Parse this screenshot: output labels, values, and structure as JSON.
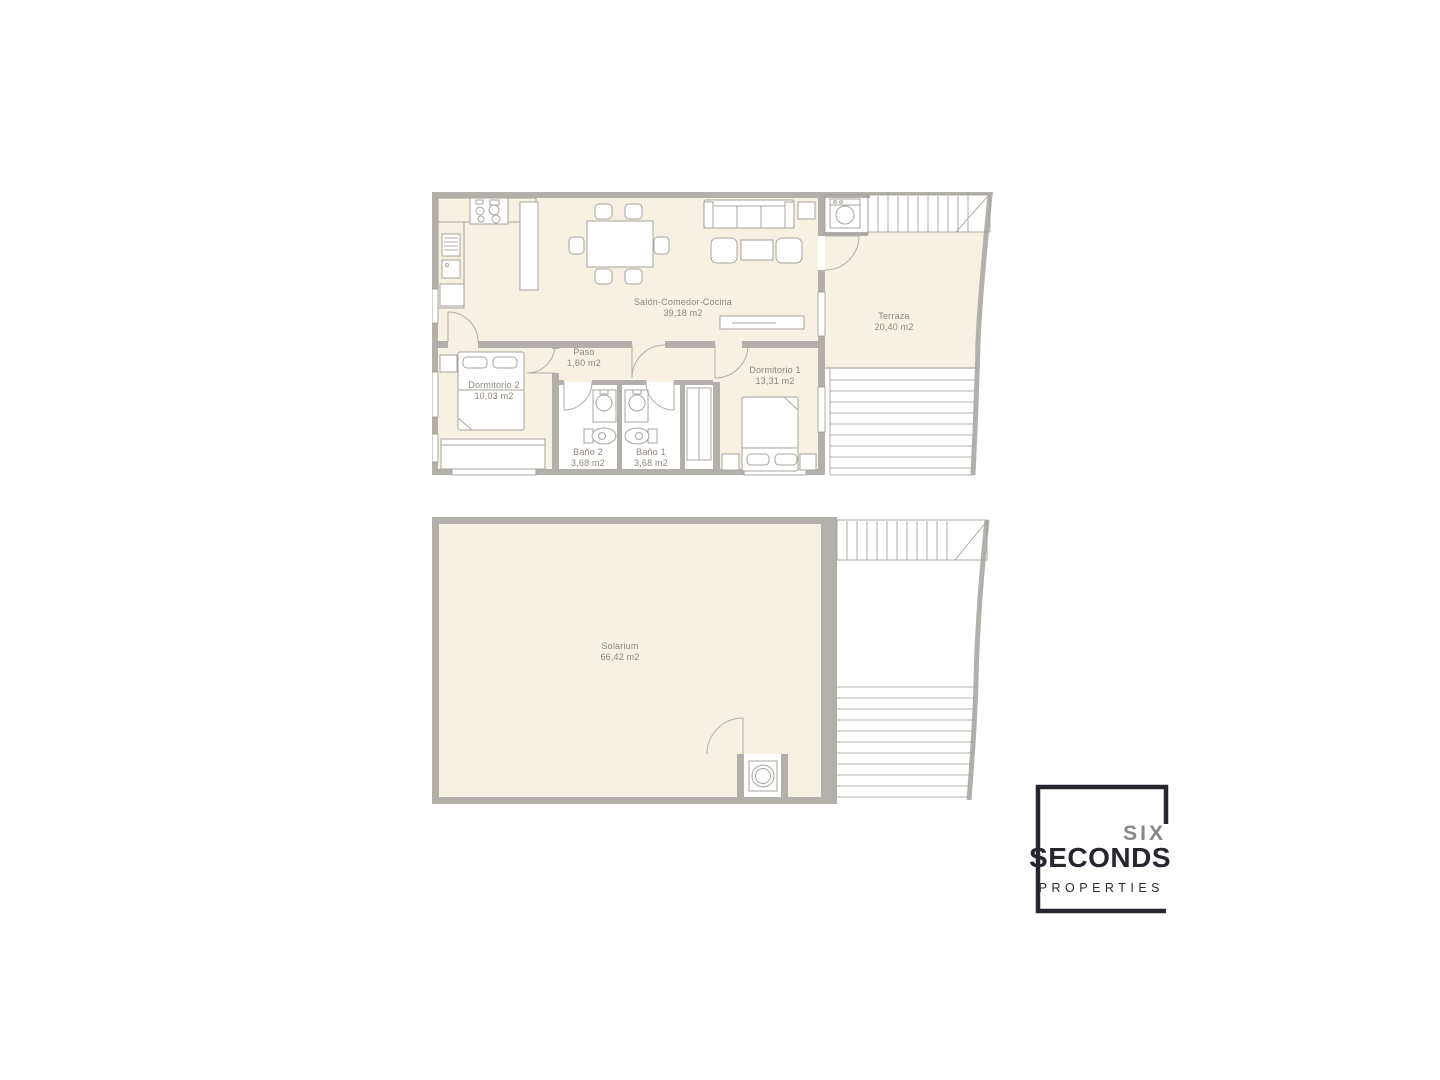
{
  "document": {
    "type": "floor-plan-sheet"
  },
  "floor1": {
    "salon": {
      "name": "Salón-Comedor-Cocina",
      "area": "39,18 m2"
    },
    "paso": {
      "name": "Paso",
      "area": "1,60 m2"
    },
    "dormitorio1": {
      "name": "Dormitorio 1",
      "area": "13,31 m2"
    },
    "dormitorio2": {
      "name": "Dormitorio 2",
      "area": "10,03 m2"
    },
    "bano1": {
      "name": "Baño 1",
      "area": "3,68 m2"
    },
    "bano2": {
      "name": "Baño 2",
      "area": "3,68 m2"
    },
    "terraza": {
      "name": "Terraza",
      "area": "20,40 m2"
    }
  },
  "floor2": {
    "solarium": {
      "name": "Solarium",
      "area": "66,42 m2"
    }
  },
  "logo": {
    "word1": "SIX",
    "word2": "SECONDS",
    "word3": "PROPERTIES"
  },
  "colors": {
    "floor_fill": "#f6f1e1",
    "wall": "#b3b0ab",
    "line": "#9d9a94",
    "label_text": "#8d8678",
    "logo_dark": "#26262e",
    "logo_gray": "#87878b",
    "background": "#ffffff"
  }
}
